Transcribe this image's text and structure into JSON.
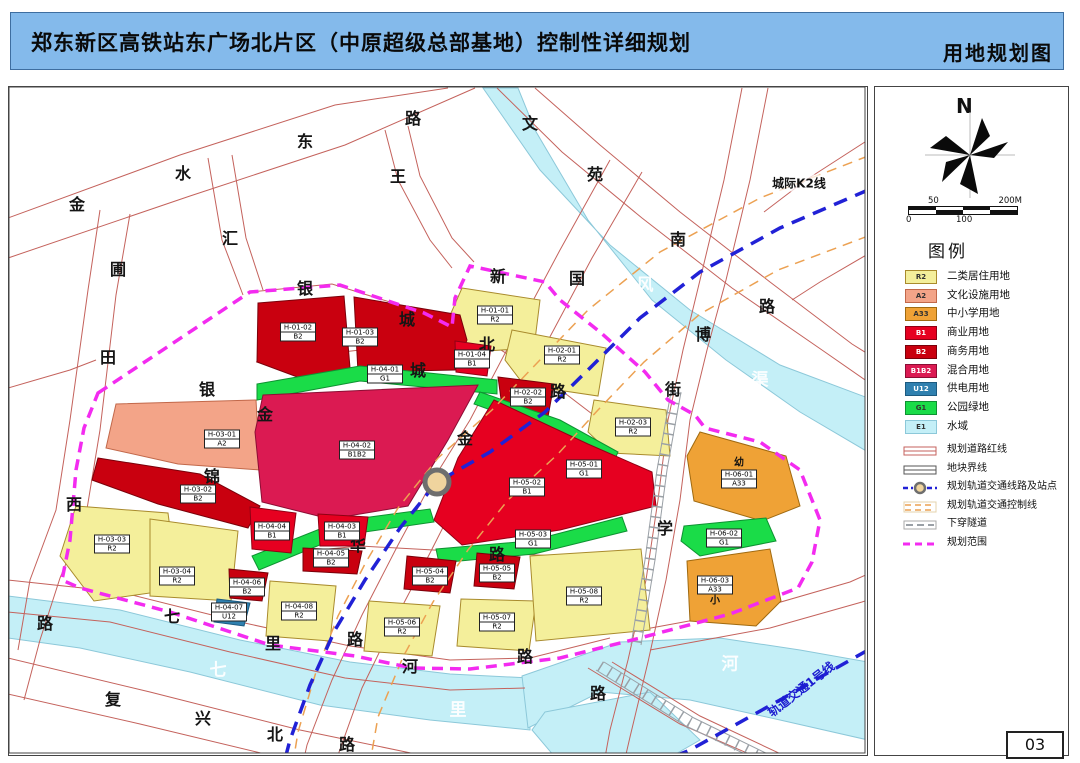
{
  "header": {
    "title": "郑东新区高铁站东广场北片区（中原超级总部基地）控制性详细规划",
    "subtitle": "用地规划图"
  },
  "page_number": "03",
  "compass": {
    "north_label": "N"
  },
  "scale_bar": {
    "top_left": "50",
    "top_right": "200M",
    "bottom_left": "0",
    "bottom_mid": "100"
  },
  "legend": {
    "title": "图例",
    "items": [
      {
        "code": "R2",
        "label": "二类居住用地",
        "dark": false
      },
      {
        "code": "A2",
        "label": "文化设施用地",
        "dark": false
      },
      {
        "code": "A33",
        "label": "中小学用地",
        "dark": false
      },
      {
        "code": "B1",
        "label": "商业用地",
        "dark": true
      },
      {
        "code": "B2",
        "label": "商务用地",
        "dark": true
      },
      {
        "code": "B1B2",
        "label": "混合用地",
        "dark": true
      },
      {
        "code": "U12",
        "label": "供电用地",
        "dark": true
      },
      {
        "code": "G1",
        "label": "公园绿地",
        "dark": false
      },
      {
        "code": "E1",
        "label": "水域",
        "dark": false
      }
    ],
    "line_items": [
      {
        "type": "road_red",
        "label": "规划道路红线"
      },
      {
        "type": "block_line",
        "label": "地块界线"
      },
      {
        "type": "rail_station",
        "label": "规划轨道交通线路及站点"
      },
      {
        "type": "rail_control",
        "label": "规划轨道交通控制线"
      },
      {
        "type": "tunnel",
        "label": "下穿隧道"
      },
      {
        "type": "boundary",
        "label": "规划范围"
      }
    ]
  },
  "map": {
    "colors": {
      "R2": "#F4EF9B",
      "A2": "#F3A488",
      "A33": "#EFA236",
      "B1": "#E60020",
      "B2": "#C9000F",
      "B1B2": "#DB1A52",
      "U12": "#2F80AF",
      "G1": "#1ADC48",
      "E1": "#C4EFF7"
    },
    "strokes": {
      "R2": "#A98B2D",
      "A2": "#C2684A",
      "A33": "#A06A10",
      "B1": "#8F0014",
      "B2": "#7A000A",
      "B1B2": "#8C0D34",
      "U12": "#1C5A80",
      "G1": "#0E9232",
      "E1": "#8CC8D9"
    },
    "line_colors": {
      "boundary": "#F32BF0",
      "rail": "#2121D6",
      "control": "#ECA152",
      "road": "#C4625C",
      "tunnel": "#9AA0A6"
    },
    "rail_labels": [
      {
        "text": "城际K2线",
        "x": 799,
        "y": 183,
        "color": "#111111",
        "rotate": 0,
        "size": 12
      },
      {
        "text": "轨道交通1号线",
        "x": 801,
        "y": 689,
        "color": "#1B1BD0",
        "rotate": -38,
        "size": 12
      }
    ],
    "road_labels": [
      {
        "t": "金",
        "x": 77,
        "y": 203
      },
      {
        "t": "水",
        "x": 183,
        "y": 172
      },
      {
        "t": "东",
        "x": 305,
        "y": 140
      },
      {
        "t": "路",
        "x": 413,
        "y": 117
      },
      {
        "t": "圃",
        "x": 118,
        "y": 268
      },
      {
        "t": "田",
        "x": 108,
        "y": 356
      },
      {
        "t": "西",
        "x": 74,
        "y": 503
      },
      {
        "t": "路",
        "x": 45,
        "y": 622
      },
      {
        "t": "汇",
        "x": 230,
        "y": 237
      },
      {
        "t": "王",
        "x": 398,
        "y": 175
      },
      {
        "t": "文",
        "x": 530,
        "y": 122
      },
      {
        "t": "苑",
        "x": 595,
        "y": 173
      },
      {
        "t": "南",
        "x": 678,
        "y": 238
      },
      {
        "t": "路",
        "x": 767,
        "y": 305
      },
      {
        "t": "新",
        "x": 498,
        "y": 275
      },
      {
        "t": "国",
        "x": 577,
        "y": 277
      },
      {
        "t": "银",
        "x": 305,
        "y": 287
      },
      {
        "t": "城",
        "x": 407,
        "y": 318
      },
      {
        "t": "北",
        "x": 487,
        "y": 343
      },
      {
        "t": "路",
        "x": 558,
        "y": 390
      },
      {
        "t": "城",
        "x": 418,
        "y": 369
      },
      {
        "t": "金",
        "x": 465,
        "y": 437
      },
      {
        "t": "博",
        "x": 703,
        "y": 333
      },
      {
        "t": "街",
        "x": 673,
        "y": 388
      },
      {
        "t": "学",
        "x": 665,
        "y": 527
      },
      {
        "t": "路",
        "x": 598,
        "y": 692
      },
      {
        "t": "银",
        "x": 207,
        "y": 388
      },
      {
        "t": "金",
        "x": 265,
        "y": 413
      },
      {
        "t": "锦",
        "x": 212,
        "y": 475
      },
      {
        "t": "华",
        "x": 358,
        "y": 544
      },
      {
        "t": "路",
        "x": 497,
        "y": 553
      },
      {
        "t": "七",
        "x": 172,
        "y": 615
      },
      {
        "t": "里",
        "x": 273,
        "y": 642
      },
      {
        "t": "路",
        "x": 355,
        "y": 638
      },
      {
        "t": "河",
        "x": 410,
        "y": 665
      },
      {
        "t": "路",
        "x": 525,
        "y": 655
      },
      {
        "t": "复",
        "x": 113,
        "y": 698
      },
      {
        "t": "兴",
        "x": 203,
        "y": 717
      },
      {
        "t": "北",
        "x": 275,
        "y": 733
      },
      {
        "t": "路",
        "x": 347,
        "y": 743
      }
    ],
    "water_labels": [
      {
        "t": "东",
        "x": 545,
        "y": 212
      },
      {
        "t": "风",
        "x": 645,
        "y": 283
      },
      {
        "t": "渠",
        "x": 760,
        "y": 378
      },
      {
        "t": "七",
        "x": 218,
        "y": 668
      },
      {
        "t": "里",
        "x": 458,
        "y": 708
      },
      {
        "t": "河",
        "x": 730,
        "y": 662
      }
    ],
    "school_marks": [
      {
        "t": "幼",
        "x": 739,
        "y": 461
      },
      {
        "t": "小",
        "x": 715,
        "y": 599
      }
    ],
    "parcels": [
      {
        "id": "H-01-01",
        "code": "R2",
        "x": 495,
        "y": 315
      },
      {
        "id": "H-01-02",
        "code": "B2",
        "x": 298,
        "y": 332
      },
      {
        "id": "H-01-03",
        "code": "B2",
        "x": 360,
        "y": 337
      },
      {
        "id": "H-01-04",
        "code": "B1",
        "x": 472,
        "y": 359
      },
      {
        "id": "H-02-01",
        "code": "R2",
        "x": 562,
        "y": 355
      },
      {
        "id": "H-02-02",
        "code": "B2",
        "x": 528,
        "y": 397
      },
      {
        "id": "H-02-03",
        "code": "R2",
        "x": 633,
        "y": 427
      },
      {
        "id": "H-03-01",
        "code": "A2",
        "x": 222,
        "y": 439
      },
      {
        "id": "H-03-02",
        "code": "B2",
        "x": 198,
        "y": 494
      },
      {
        "id": "H-03-03",
        "code": "R2",
        "x": 112,
        "y": 544
      },
      {
        "id": "H-03-04",
        "code": "R2",
        "x": 177,
        "y": 576
      },
      {
        "id": "H-04-01",
        "code": "G1",
        "x": 385,
        "y": 374
      },
      {
        "id": "H-04-02",
        "code": "B1B2",
        "x": 357,
        "y": 450
      },
      {
        "id": "H-04-03",
        "code": "B1",
        "x": 342,
        "y": 531
      },
      {
        "id": "H-04-04",
        "code": "B1",
        "x": 272,
        "y": 531
      },
      {
        "id": "H-04-05",
        "code": "B2",
        "x": 331,
        "y": 558
      },
      {
        "id": "H-04-06",
        "code": "B2",
        "x": 247,
        "y": 587
      },
      {
        "id": "H-04-07",
        "code": "U12",
        "x": 229,
        "y": 612
      },
      {
        "id": "H-04-08",
        "code": "R2",
        "x": 299,
        "y": 611
      },
      {
        "id": "H-05-01",
        "code": "G1",
        "x": 584,
        "y": 469
      },
      {
        "id": "H-05-02",
        "code": "B1",
        "x": 527,
        "y": 487
      },
      {
        "id": "H-05-03",
        "code": "G1",
        "x": 533,
        "y": 539
      },
      {
        "id": "H-05-04",
        "code": "B2",
        "x": 430,
        "y": 576
      },
      {
        "id": "H-05-05",
        "code": "B2",
        "x": 497,
        "y": 573
      },
      {
        "id": "H-05-06",
        "code": "R2",
        "x": 402,
        "y": 627
      },
      {
        "id": "H-05-07",
        "code": "R2",
        "x": 497,
        "y": 622
      },
      {
        "id": "H-05-08",
        "code": "R2",
        "x": 584,
        "y": 596
      },
      {
        "id": "H-06-01",
        "code": "A33",
        "x": 739,
        "y": 479
      },
      {
        "id": "H-06-02",
        "code": "G1",
        "x": 724,
        "y": 538
      },
      {
        "id": "H-06-03",
        "code": "A33",
        "x": 715,
        "y": 585
      }
    ]
  }
}
